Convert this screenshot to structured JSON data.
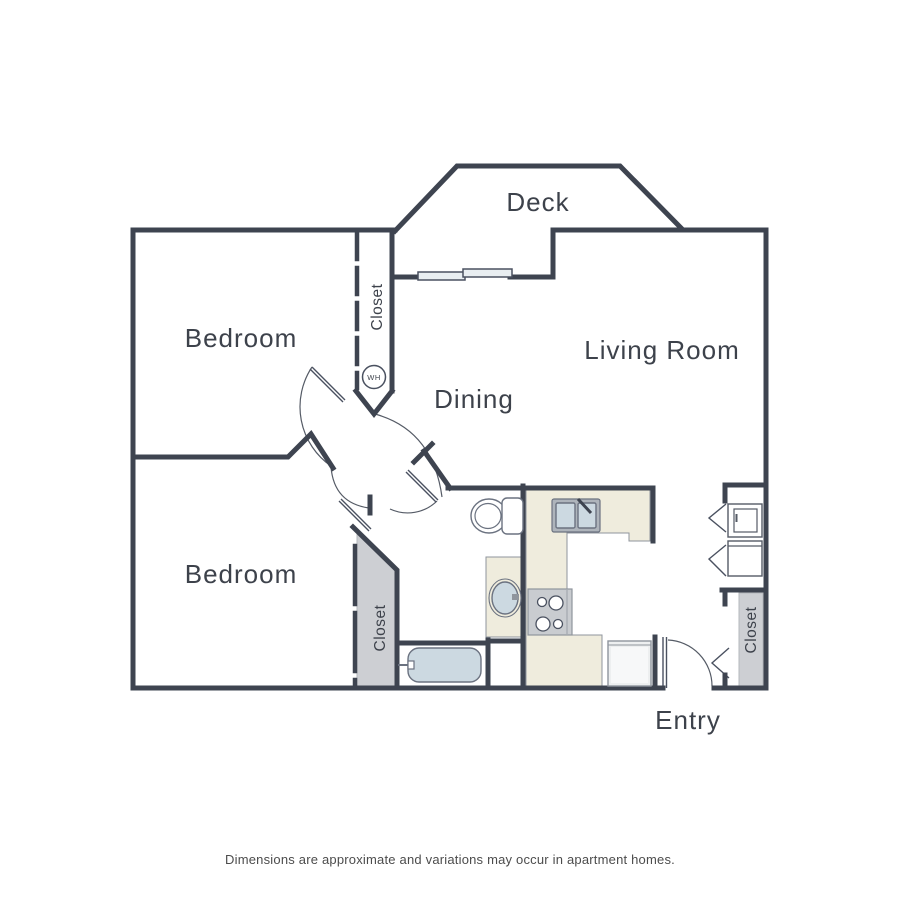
{
  "plan": {
    "rooms": {
      "deck": "Deck",
      "living_room": "Living Room",
      "dining": "Dining",
      "bedroom_upper": "Bedroom",
      "bedroom_lower": "Bedroom",
      "entry": "Entry"
    },
    "closets": {
      "hall_closet": "Closet",
      "bedroom_closet": "Closet",
      "entry_closet": "Closet"
    },
    "fixtures": {
      "water_heater_abbr": "WH"
    },
    "disclaimer": "Dimensions are approximate and variations may occur in apartment homes.",
    "colors": {
      "wall": "#3e4450",
      "counter": "#efecdd",
      "closet_fill": "#cdcfd3",
      "fixture_blue": "#ccd9e1",
      "appliance_gray": "#c9ccd0",
      "label_text": "#3d424b"
    }
  }
}
